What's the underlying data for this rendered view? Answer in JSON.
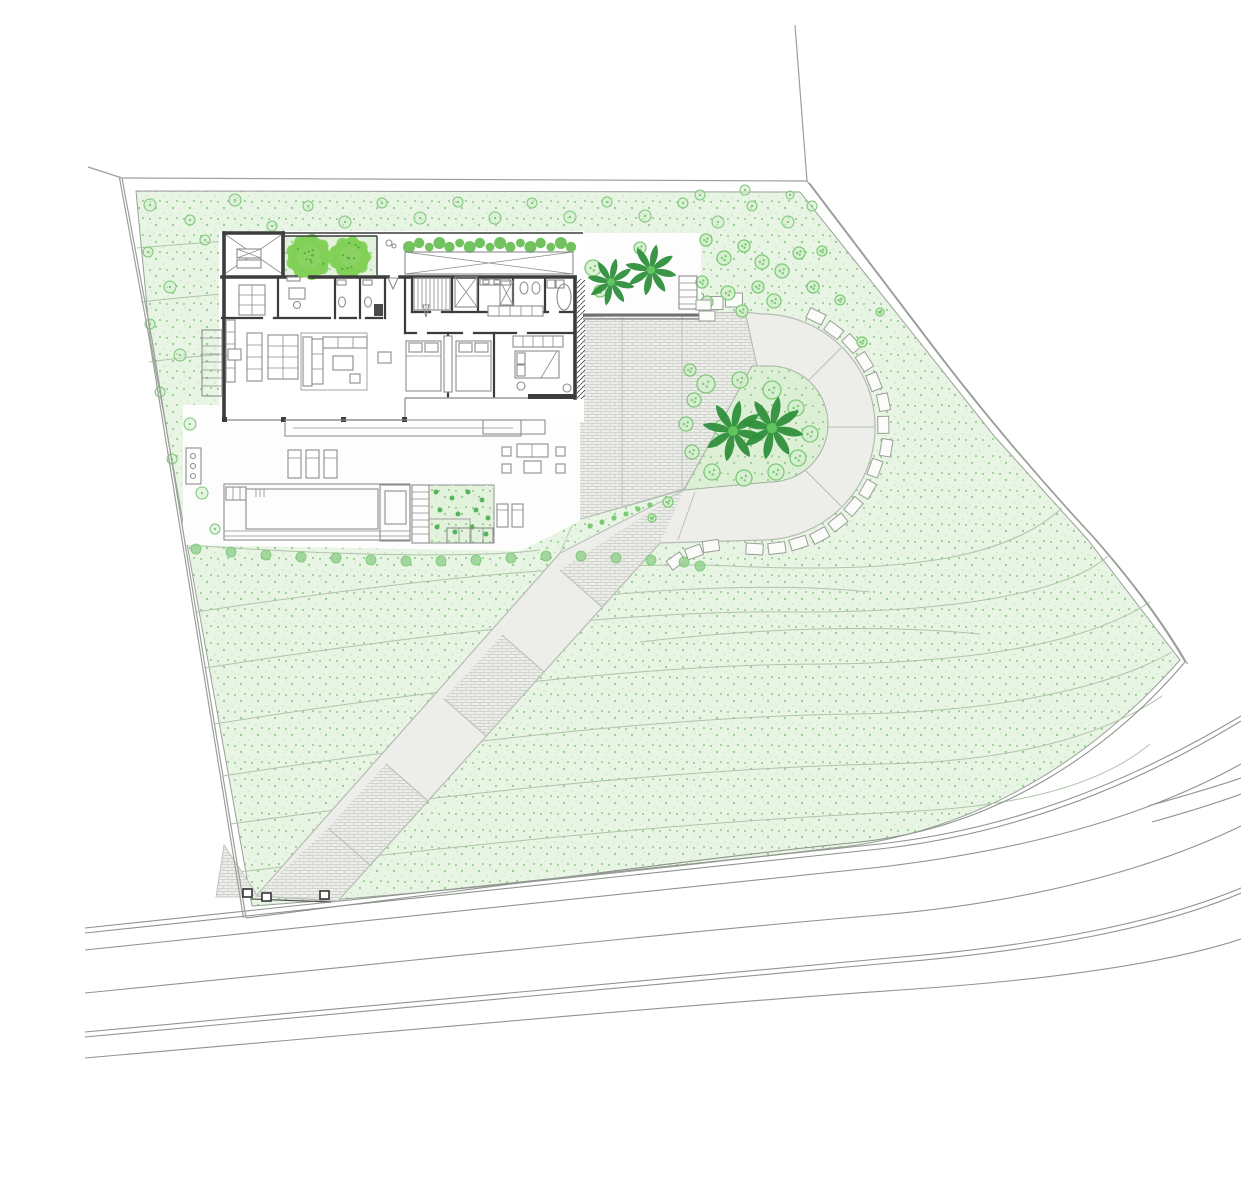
{
  "plan_title": "",
  "palette": {
    "bg": "#ffffff",
    "greenBase": "#e9f5e4",
    "greenDot1": "#98d193",
    "greenDot2": "#cfe9cb",
    "island": "#ddf0d6",
    "courtyard": "#e3f2dc",
    "treeStroke": "#79c675",
    "treeFill": "#d4edcf",
    "bigTree": "#7fcf55",
    "hedge": "#63bd4f",
    "palmDark": "#2f8f3c",
    "palmLight": "#62c45e",
    "bushRing": "#7ccb74",
    "contour": "#aec4a9",
    "boundary": "#9aa099",
    "road": "#8f948e",
    "wall": "#3c3c3c",
    "furn": "#8d8d8d",
    "glass": "#9b9b9b",
    "paved": "#ededea",
    "pavedEdge": "#b7bbb5",
    "brickLine": "#c9ccc6",
    "blockFill": "#fbfbfa",
    "blockStroke": "#999e98",
    "white": "#fdfdfd",
    "darkBand": "#6f6f6f",
    "bedDot": "#56b45c"
  },
  "paths": {
    "plot_green": "M136,191 L800,192 L910,330 L995,437 L1088,540 L1180,660 C1102,748 998,822 858,845 C714,862 494,889 252,906 L150,338 Z",
    "boundary_left": "M122,178 L152,340 L246,918",
    "boundary_top": "M88,167 L122,178 L807,181",
    "boundary_tick": "M795,25 L807,181",
    "boundary_diag": "M807,181 L920,330 Q1000,437 1093,537 C1135,585 1163,624 1185,662",
    "green_road_edge": "M246,918 C500,886 720,856 860,842 C1000,827 1112,748 1185,662",
    "roads": [
      "M85,928 C420,893 700,862 870,845 C1010,831 1130,782 1241,716",
      "M85,933 C420,898 700,867 870,850 C1010,836 1133,787 1241,721",
      "M85,950 C420,915 700,884 872,868 C1015,852 1140,820 1241,764",
      "M85,993 C420,960 700,930 880,915 C1030,902 1150,870 1241,826",
      "M85,1032 C430,1000 710,972 890,958 C1040,946 1160,922 1241,888",
      "M85,1037 C430,1005 710,977 890,963 C1040,951 1162,927 1241,893",
      "M85,1058 C430,1028 720,1002 900,990 C1050,980 1165,964 1241,939",
      "M1148,806 C1180,797 1212,788 1241,778",
      "M1152,822 C1184,813 1214,804 1241,794"
    ],
    "contours": [
      "M137,248 C250,238 380,232 468,236",
      "M141,302 C230,292 330,285 398,288",
      "M149,362 C205,354 262,351 302,353",
      "M196,612 C420,578 610,560 730,566 C900,574 1005,560 1062,508",
      "M205,668 C430,632 645,610 795,612 C955,613 1068,592 1108,556",
      "M214,724 C440,688 665,664 825,664 C985,663 1092,640 1150,602",
      "M223,776 C450,741 685,716 852,714 C1000,712 1108,688 1172,652",
      "M231,824 C460,792 700,768 880,764 C1012,762 1104,736 1162,696",
      "M240,872 C480,842 720,820 900,812 C1022,807 1102,784 1150,744",
      "M188,545 C340,556 480,558 540,550",
      "M560,600 C680,586 790,584 870,592",
      "M640,642 C760,628 880,624 980,634"
    ]
  },
  "driveway": {
    "court_path": "M573,317 L745,312 L757,366 L684,489 L574,521 Z",
    "court_seams": [
      "M622,317 L622,507",
      "M682,314 L682,491"
    ],
    "loop_path": "M745,312 L762,314 A113,113 0 1 1 762,540 L660,543 L338,901 L256,896 L560,553 C620,522 655,505 684,490 L757,366 Z",
    "island_path": "M752,366 L770,366 A58,58 0 0 1 770,482 L684,490 Z",
    "wedge_path": "M684,490 C655,505 620,522 560,553 L574,521 Z",
    "gate_apron": "M224,845 L256,893 L250,897 L216,897 Z",
    "ramp_seams": [
      "M602,607 L560,570",
      "M544,672 L502,635",
      "M486,736 L444,699",
      "M428,801 L386,764",
      "M370,865 L328,828"
    ],
    "hatch_panels": [
      "M660,543 L602,607 L560,570 L684,490 Z",
      "M544,672 L486,736 L444,699 L502,635 Z",
      "M428,801 L370,865 L328,828 L386,764 Z",
      "M338,901 L256,896 L328,828 L370,865 Z"
    ],
    "radial_seams": [
      "M804,385 L841,348",
      "M822,427 L874,427",
      "M804,469 L841,506",
      "M695,492 L678,540"
    ]
  },
  "blocks": {
    "arc": {
      "cx": 762,
      "cy": 427,
      "r": 123,
      "start": -64,
      "end": 97,
      "step": 10.5,
      "w": 17,
      "h": 11
    },
    "row": {
      "x0": 578,
      "y": 301,
      "step": 19.5,
      "n": 9,
      "w": 17,
      "h": 12
    },
    "ramp": [
      [
        676,
        561,
        -35
      ],
      [
        694,
        552,
        -20
      ],
      [
        711,
        546,
        -8
      ]
    ],
    "terrace_rows": [
      {
        "x0": 586,
        "y": 243,
        "step": 17,
        "n": 6,
        "w": 15,
        "h": 10
      },
      {
        "x0": 592,
        "y": 254,
        "step": 17,
        "n": 6,
        "w": 15,
        "h": 9
      }
    ]
  },
  "gate": {
    "posts": [
      [
        247,
        893
      ],
      [
        266,
        897
      ],
      [
        324,
        895
      ]
    ],
    "fence": "M251,899 L331,902"
  },
  "vegetation": {
    "north_trees": [
      [
        150,
        205,
        6
      ],
      [
        190,
        220,
        5
      ],
      [
        235,
        200,
        6
      ],
      [
        272,
        226,
        5
      ],
      [
        308,
        206,
        5
      ],
      [
        345,
        222,
        6
      ],
      [
        382,
        203,
        5
      ],
      [
        420,
        218,
        6
      ],
      [
        458,
        202,
        5
      ],
      [
        495,
        218,
        6
      ],
      [
        532,
        203,
        5
      ],
      [
        570,
        217,
        6
      ],
      [
        607,
        202,
        5
      ],
      [
        645,
        216,
        6
      ],
      [
        683,
        203,
        5
      ],
      [
        718,
        222,
        6
      ],
      [
        752,
        206,
        5
      ],
      [
        788,
        222,
        6
      ],
      [
        812,
        206,
        5
      ],
      [
        148,
        252,
        5
      ],
      [
        170,
        287,
        6
      ],
      [
        150,
        324,
        5
      ],
      [
        180,
        355,
        6
      ],
      [
        160,
        392,
        5
      ],
      [
        190,
        424,
        6
      ],
      [
        172,
        459,
        5
      ],
      [
        202,
        493,
        6
      ],
      [
        215,
        529,
        5
      ],
      [
        250,
        262,
        5
      ],
      [
        228,
        300,
        5
      ],
      [
        205,
        240,
        5
      ],
      [
        265,
        248,
        4
      ],
      [
        300,
        240,
        4
      ],
      [
        700,
        195,
        5
      ],
      [
        745,
        190,
        5
      ],
      [
        790,
        195,
        4
      ]
    ],
    "east_bushes": [
      [
        706,
        240,
        6
      ],
      [
        724,
        258,
        7
      ],
      [
        744,
        246,
        6
      ],
      [
        762,
        262,
        7
      ],
      [
        702,
        282,
        6
      ],
      [
        728,
        293,
        7
      ],
      [
        758,
        287,
        6
      ],
      [
        782,
        271,
        7
      ],
      [
        799,
        253,
        6
      ],
      [
        813,
        287,
        6
      ],
      [
        774,
        301,
        7
      ],
      [
        742,
        311,
        6
      ],
      [
        707,
        302,
        6
      ],
      [
        822,
        251,
        5
      ],
      [
        840,
        300,
        5
      ],
      [
        862,
        342,
        5
      ],
      [
        880,
        312,
        4
      ]
    ],
    "island_bushes": [
      [
        706,
        384,
        9
      ],
      [
        740,
        380,
        8
      ],
      [
        772,
        390,
        9
      ],
      [
        796,
        408,
        8
      ],
      [
        810,
        434,
        8
      ],
      [
        798,
        458,
        8
      ],
      [
        776,
        472,
        8
      ],
      [
        744,
        478,
        8
      ],
      [
        712,
        472,
        8
      ],
      [
        692,
        452,
        7
      ],
      [
        686,
        424,
        7
      ],
      [
        694,
        400,
        7
      ],
      [
        722,
        428,
        8
      ],
      [
        757,
        426,
        8
      ],
      [
        690,
        370,
        6
      ],
      [
        668,
        502,
        5
      ],
      [
        652,
        518,
        4
      ]
    ],
    "tree_row": [
      [
        196,
        549
      ],
      [
        231,
        552
      ],
      [
        266,
        555
      ],
      [
        301,
        557
      ],
      [
        336,
        558
      ],
      [
        371,
        560
      ],
      [
        406,
        561
      ],
      [
        441,
        561
      ],
      [
        476,
        560
      ],
      [
        511,
        558
      ],
      [
        546,
        556
      ],
      [
        581,
        556
      ],
      [
        616,
        558
      ],
      [
        651,
        560
      ],
      [
        684,
        562
      ],
      [
        700,
        566
      ]
    ],
    "wedge_dots": [
      [
        590,
        526
      ],
      [
        602,
        522
      ],
      [
        614,
        518
      ],
      [
        626,
        514
      ],
      [
        638,
        509
      ],
      [
        650,
        505
      ]
    ],
    "bed_dots": [
      [
        436,
        492
      ],
      [
        452,
        498
      ],
      [
        468,
        492
      ],
      [
        482,
        500
      ],
      [
        440,
        510
      ],
      [
        458,
        514
      ],
      [
        476,
        510
      ],
      [
        488,
        518
      ],
      [
        437,
        527
      ],
      [
        455,
        532
      ],
      [
        472,
        527
      ],
      [
        486,
        534
      ]
    ],
    "big_trees": [
      [
        309,
        257,
        21
      ],
      [
        350,
        257,
        19
      ]
    ],
    "terrace_palms": [
      [
        611,
        282,
        24
      ],
      [
        651,
        270,
        26
      ]
    ],
    "island_palms": [
      [
        733,
        431,
        31
      ],
      [
        772,
        428,
        32
      ]
    ],
    "terrace_bushes": [
      [
        593,
        268,
        8
      ],
      [
        600,
        291,
        6
      ],
      [
        640,
        248,
        6
      ]
    ],
    "hedge": {
      "x0": 409,
      "x1": 571,
      "y": 245,
      "r": 6,
      "n": 17
    },
    "courtyard_rect": [
      283,
      236,
      94,
      39
    ],
    "garden_bed_rect": [
      429,
      485,
      65,
      58
    ]
  }
}
